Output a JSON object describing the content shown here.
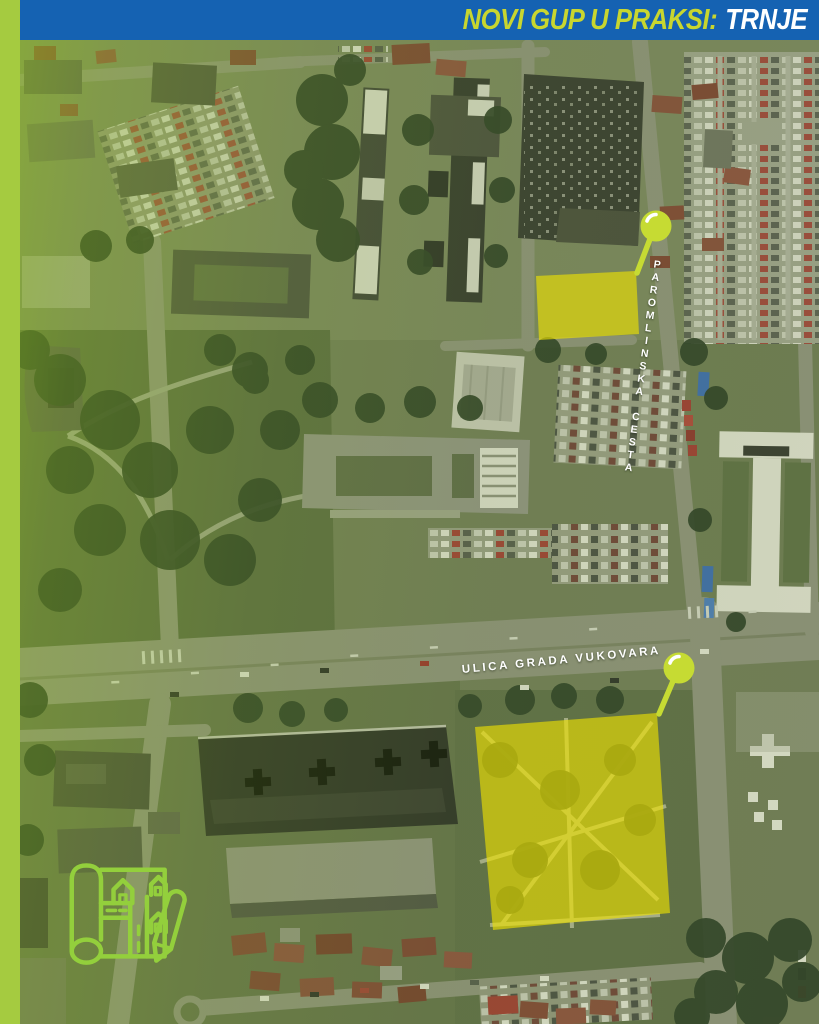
{
  "header": {
    "title": "NOVI GUP U PRAKSI:",
    "highlight": "TRNJE"
  },
  "map": {
    "street_labels": {
      "paromlinska": "PAROMLINSKA CESTA",
      "vukovara": "ULICA GRADA VUKOVARA"
    },
    "highlighted_sites": [
      "site-paromlinska",
      "site-vukovara"
    ]
  },
  "colors": {
    "header_blue": "#1562B2",
    "accent_green": "#A5CB40",
    "pin_green": "#C6DB33",
    "highlight_yellow": "#F0E400",
    "icon_green": "#93CF3C",
    "label_white": "#FFFFFF"
  }
}
